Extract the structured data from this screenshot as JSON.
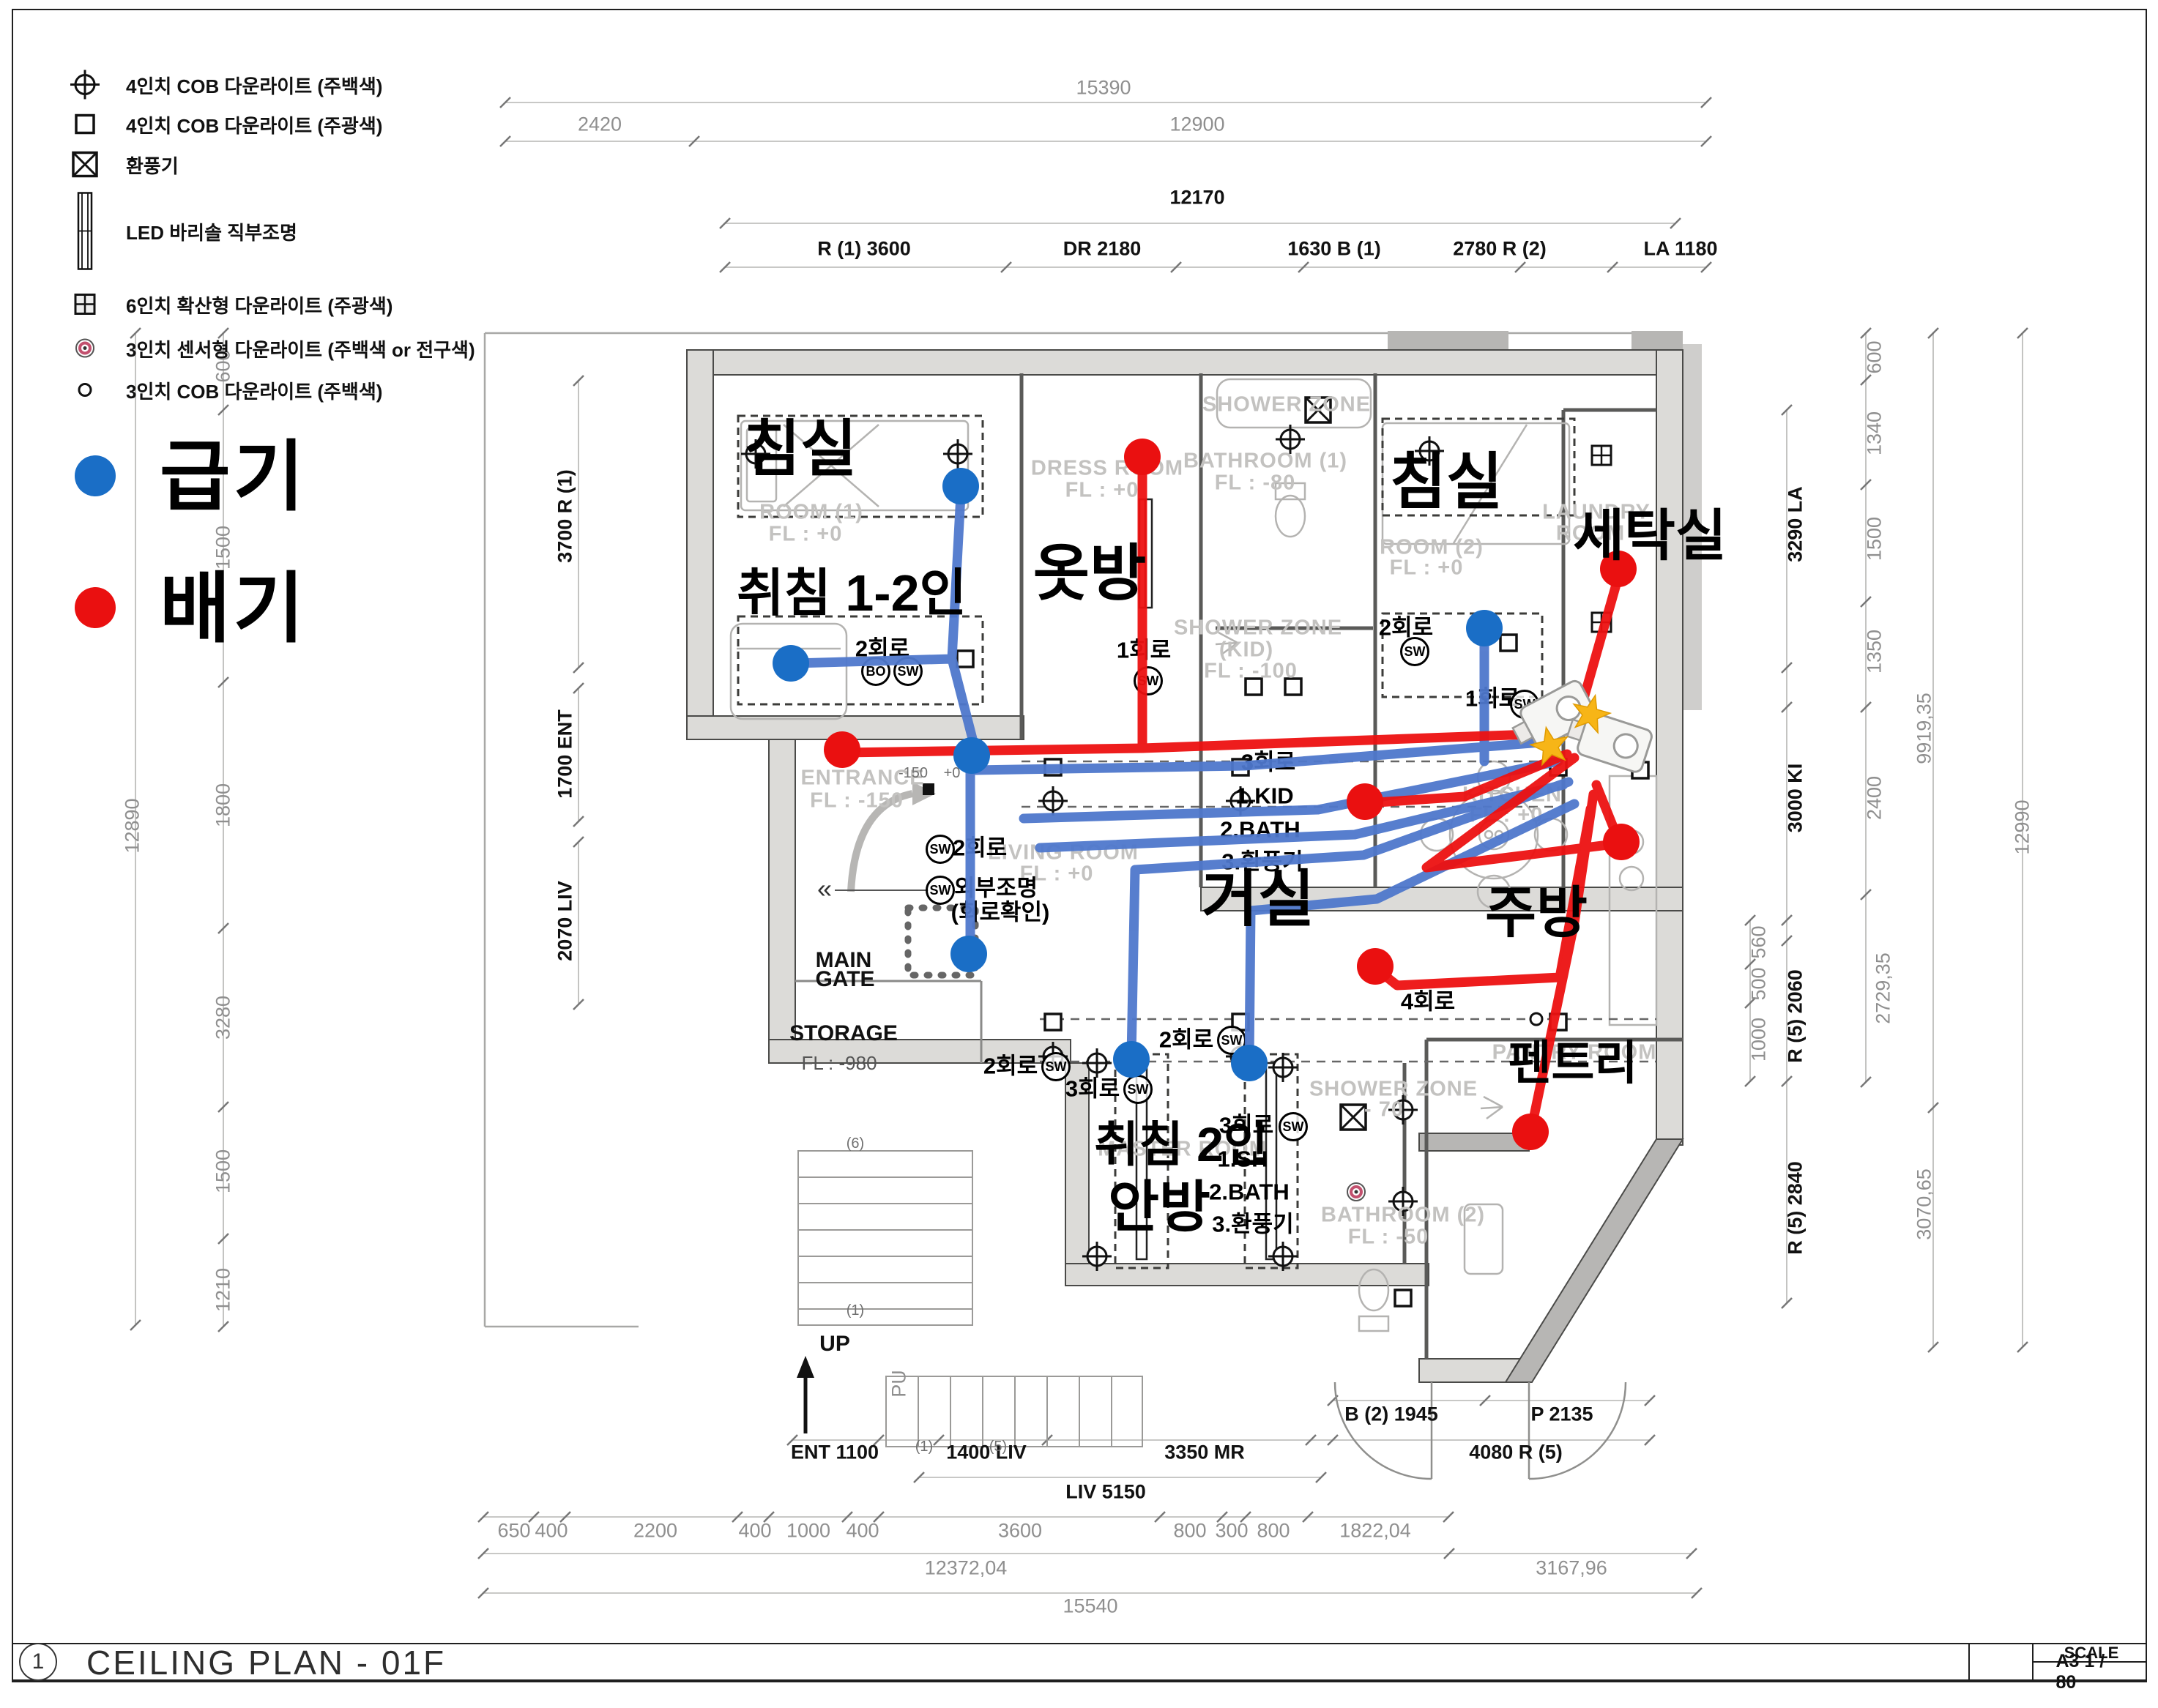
{
  "title": {
    "number": "1",
    "text": "CEILING PLAN - 01F",
    "scale_label": "SCALE",
    "scale_value": "A3 1 / 80"
  },
  "legend": {
    "items": [
      {
        "icon": "cob-4inch-downlight-warm-icon",
        "label": "4인치 COB 다운라이트 (주백색)"
      },
      {
        "icon": "cob-4inch-downlight-cool-icon",
        "label": "4인치 COB 다운라이트 (주광색)"
      },
      {
        "icon": "ventilation-fan-icon",
        "label": "환풍기"
      },
      {
        "icon": "led-barisol-light-icon",
        "label": "LED 바리솔 직부조명"
      },
      {
        "icon": "diffuse-6inch-downlight-icon",
        "label": "6인치 확산형 다운라이트 (주광색)"
      },
      {
        "icon": "sensor-3inch-downlight-icon",
        "label": "3인치 센서형 다운라이트 (주백색 or 전구색)"
      },
      {
        "icon": "cob-3inch-downlight-icon",
        "label": "3인치 COB 다운라이트 (주백색)"
      }
    ]
  },
  "air": {
    "supply_label": "급기",
    "supply_color": "#1a6ec6",
    "exhaust_label": "배기",
    "exhaust_color": "#ea1010",
    "duct_blue": "#4f78cc",
    "duct_red": "#ed1111",
    "star_color": "#f7b517"
  },
  "dims": {
    "top": [
      "15390",
      "2420",
      "12900",
      "12170",
      "R (1) 3600",
      "DR 2180",
      "1630 B (1)",
      "2780 R (2)",
      "LA 1180"
    ],
    "left": [
      "12890",
      "600",
      "1500",
      "1800",
      "3280",
      "1500",
      "1210",
      "3700 R (1)",
      "1700 ENT",
      "2070 LIV"
    ],
    "right": [
      "600",
      "1340",
      "1500",
      "1350",
      "2400",
      "3290 LA",
      "3000 KI",
      "9919,35",
      "12990",
      "560",
      "500",
      "1000",
      "R (5) 2060",
      "2729,35",
      "R (5) 2840",
      "3070,65"
    ],
    "bottom": [
      "B (2) 1945",
      "P 2135",
      "ENT 1100",
      "1400 LIV",
      "3350 MR",
      "4080 R (5)",
      "LIV 5150",
      "650",
      "400",
      "2200",
      "400",
      "1000",
      "400",
      "3600",
      "800",
      "300",
      "800",
      "1822,04",
      "12372,04",
      "3167,96",
      "15540"
    ]
  },
  "plan": {
    "rooms": [
      "ROOM (1)",
      "FL : +0",
      "DRESS ROOM",
      "FL : +0",
      "SHOWER ZONE",
      "BATHROOM (1)",
      "FL : -80",
      "SHOWER ZONE",
      "(KID)",
      "FL : -100",
      "ROOM (2)",
      "FL : +0",
      "LAUNDRY",
      "ROOM",
      "ENTRANCE",
      "FL : -150",
      "LIVING ROOM",
      "FL : +0",
      "KITCHEN",
      "FL : +0",
      "MASTER ROOM",
      "PANTRY ROOM",
      "SHOWER ZONE",
      "- 70",
      "BATHROOM (2)",
      "FL : -50"
    ],
    "misc": [
      "MAIN",
      "GATE",
      "STORAGE",
      "FL : -980",
      "UP",
      "PU",
      "(6)",
      "(1)",
      "(1)",
      "(5)",
      "-150",
      "+0",
      "«"
    ],
    "circuits": [
      "2회로",
      "1회로",
      "2회로",
      "1회로",
      "3회로",
      "1.KID",
      "2.BATH",
      "3.환풍기",
      "2회로",
      "외부조명",
      "(회로확인)",
      "2회로",
      "3회로",
      "1.SH",
      "2.BATH",
      "3.환풍기",
      "4회로",
      "2회로",
      "3회로"
    ],
    "badges": [
      "BO",
      "SW",
      "SW",
      "SW",
      "SW",
      "SW",
      "SW",
      "SW",
      "SW",
      "SW",
      "SW"
    ]
  },
  "overlays": [
    "침실",
    "취침 1-2인",
    "옷방",
    "침실",
    "세탁실",
    "거실",
    "주방",
    "펜트리",
    "취침 2인",
    "안방"
  ]
}
